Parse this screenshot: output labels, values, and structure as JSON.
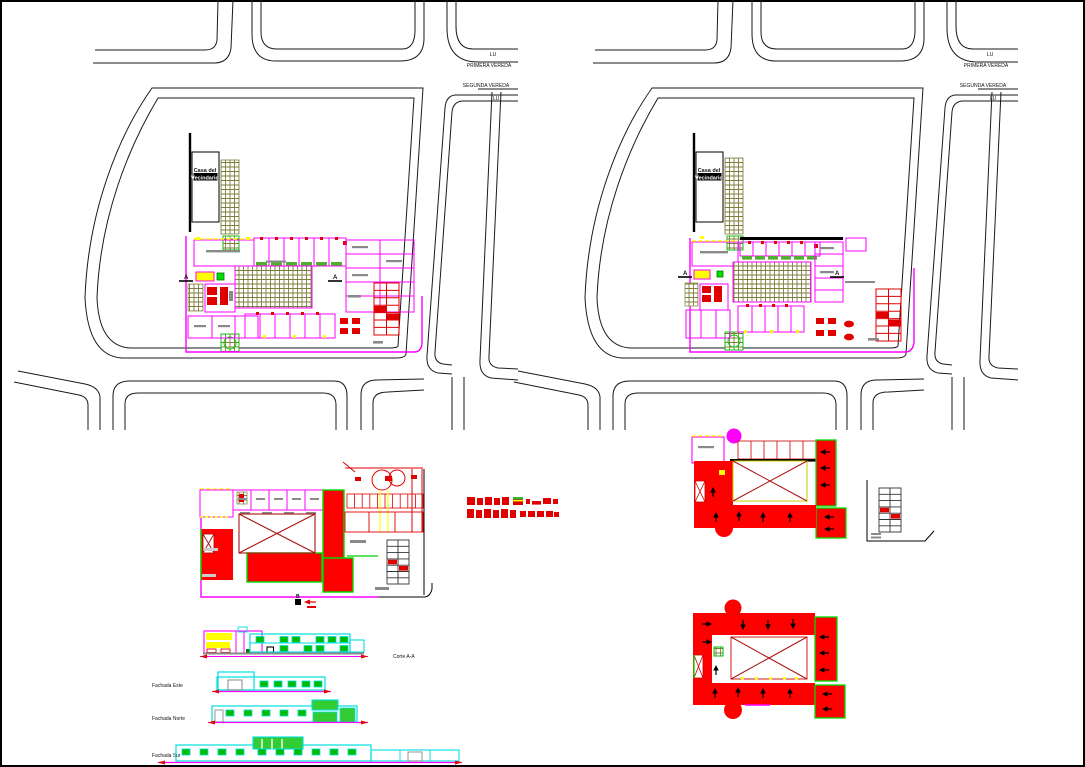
{
  "sheet": {
    "background": "#ffffff",
    "frame_color": "#000000",
    "description": "Architectural CAD sheet: two urban site plans, first floor plan, two roof plans and four elevation/section drawings"
  },
  "colors": {
    "street_line": "#1a1a1a",
    "wall_magenta": "#ff00ff",
    "roof_red": "#fe0000",
    "roof_border_green": "#00dd00",
    "courtyard_hatch_olive": "#7d7d3a",
    "elevation_cyan": "#00dede",
    "window_green": "#00bb00",
    "highlight_yellow": "#ffff00",
    "annotation_gray": "#8a8a8a",
    "section_darkred": "#aa1111"
  },
  "site_plan_left": {
    "streets": {
      "lu_upper": "LU",
      "vereda_upper": "PRIMERA VEREDA",
      "vereda_lower": "SEGUNDA VEREDA",
      "lu_lower": "LU"
    },
    "building_box": {
      "line1": "Casa del",
      "line2": "Vecindario"
    },
    "section_marker_left": "A",
    "section_marker_right": "A"
  },
  "site_plan_right": {
    "streets": {
      "lu_upper": "LU",
      "vereda_upper": "PRIMERA VEREDA",
      "vereda_lower": "SEGUNDA VEREDA",
      "lu_lower": "LU"
    },
    "building_box": {
      "line1": "Casa del",
      "line2": "Vecindario"
    },
    "section_marker_left": "A",
    "section_marker_right": "A"
  },
  "floor_plan": {
    "section_marker": "B"
  },
  "elevations": {
    "corte_label": "Corte A-A",
    "labels": [
      "Fachada Este",
      "Fachada Norte",
      "Fachada Sur"
    ]
  }
}
